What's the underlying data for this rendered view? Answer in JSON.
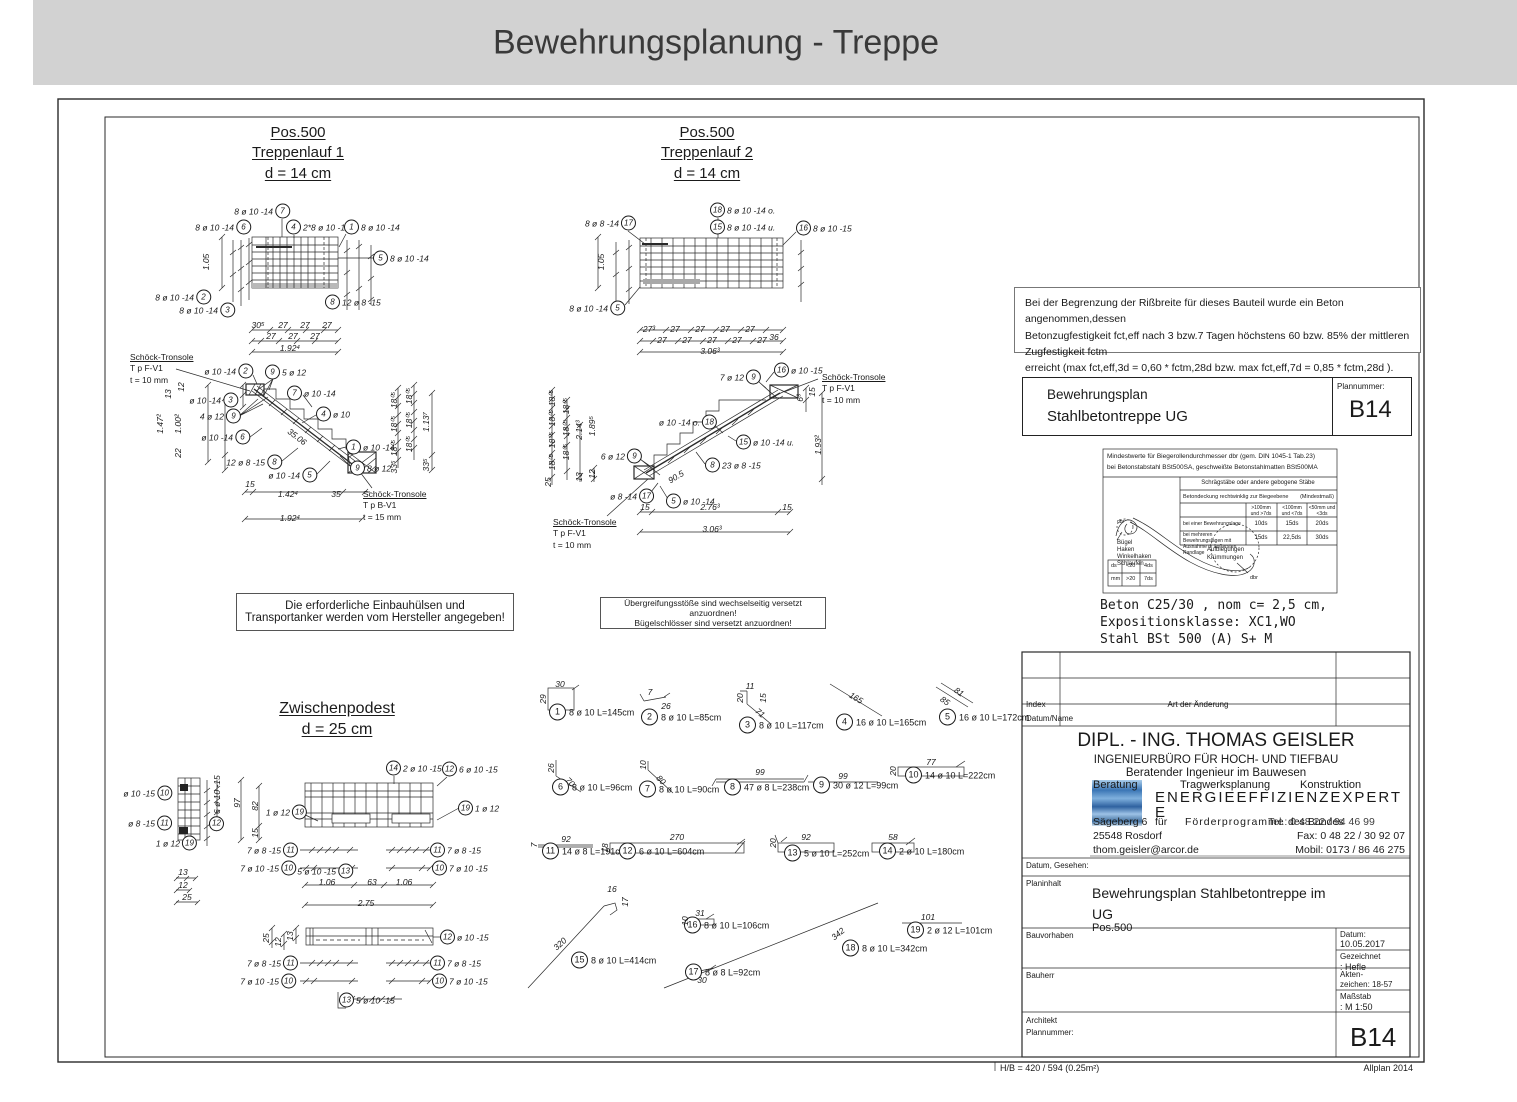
{
  "header": {
    "title": "Bewehrungsplanung - Treppe"
  },
  "lauf1": {
    "pos": "Pos.500",
    "name": "Treppenlauf 1",
    "thickness": "d = 14 cm"
  },
  "lauf2": {
    "pos": "Pos.500",
    "name": "Treppenlauf 2",
    "thickness": "d = 14 cm"
  },
  "podest": {
    "name": "Zwischenpodest",
    "thickness": "d = 25 cm"
  },
  "notes": {
    "n1a": "Die erforderliche Einbauhülsen und",
    "n1b": "Transportanker werden vom Hersteller angegeben!",
    "n2a": "Übergreifungsstöße sind wechselseitig versetzt anzuordnen!",
    "n2b": "Bügelschlösser sind versetzt anzuordnen!"
  },
  "risstext": {
    "l1": "Bei der Begrenzung der Rißbreite für dieses Bauteil wurde ein Beton angenommen,dessen",
    "l2": "Betonzugfestigkeit fct,eff nach 3 bzw.7 Tagen höchstens 60 bzw. 85% der mittleren Zugfestigkeit fctm",
    "l3": "erreicht (max  fct,eff,3d = 0,60 * fctm,28d bzw. max fct,eff,7d = 0,85 * fctm,28d ). Dies ist bei der Festlegung des",
    "l4": "Betons und der Bauausführung zu berücksichtigen."
  },
  "planbox": {
    "line1": "Bewehrungsplan",
    "line2": "Stahlbetontreppe UG",
    "plannummer_label": "Plannummer:",
    "plannummer": "B14"
  },
  "bend": {
    "h1": "Mindestwerte für Biegerollendurchmesser dbr (gem. DIN 1045-1 Tab.23)",
    "h2": "bei Betonstabstahl BSt500SA, geschweißte Betonstahlmatten BSt500MA",
    "sub1": "Schrägstäbe oder andere gebogene Stäbe",
    "sub2": "Betondeckung rechtwinklig zur Biegeebene",
    "sub2r": "(Mindestmaß)",
    "c1": ">100mm und >7ds",
    "c2": "<100mm und <7ds",
    "c3": "<50mm und <3ds",
    "r1": "bei einer Bewehrungslage",
    "r1v1": "10ds",
    "r1v2": "15ds",
    "r1v3": "20ds",
    "r2": "bei mehreren Bewehrungslagen mit Ausnahme d. äußersten Randlage",
    "r2v1": "15ds",
    "r2v2": "22,5ds",
    "r2v3": "30ds",
    "left1": "Bügel",
    "left2": "Haken",
    "left3": "Winkelhaken",
    "left4": "Schlaufen",
    "mini_ds": "ds",
    "mini_mm": "mm",
    "mini_lt": "<20",
    "mini_4": "4ds",
    "mini_gt": ">20",
    "mini_7": "7ds",
    "aufb": "Aufbiegungen",
    "krumm": "Krümmungen",
    "dbr": "dbr"
  },
  "beton": {
    "l1": "Beton C25/30 , nom c= 2,5 cm,",
    "l2": "Expositionsklasse:  XC1,WO",
    "l3": "Stahl BSt 500 (A) S+ M"
  },
  "titleblock": {
    "index": "Index",
    "art": "Art der Änderung",
    "datumname": "Datum/Name",
    "firm1": "DIPL. - ING.  THOMAS  GEISLER",
    "firm2": "INGENIEURBÜRO   FÜR   HOCH-   UND  TIEFBAU",
    "firm3": "Beratender    Ingenieur    im    Bauwesen",
    "beratung": "Beratung",
    "tragwerk": "Tragwerksplanung",
    "konstruktion": "Konstruktion",
    "energie1": "ENERGIEEFFIZIENZEXPERT",
    "energie2": "E",
    "addr1": "Sägeberg 6",
    "addr2": "25548 Rosdorf",
    "addr3": "thom.geisler@arcor.de",
    "fp1": "für",
    "fp2": "Förderprogramme",
    "bund": "des Bundes",
    "tel": "Tel.: 0 48 22 / 94 46 99",
    "fax": "Fax: 0 48 22 / 30 92 07",
    "mobil": "Mobil: 0173 / 86 46 275",
    "datumgesehen": "Datum, Gesehen:",
    "planinhalt_label": "Planinhalt",
    "planinhalt1": "Bewehrungsplan Stahlbetontreppe im",
    "planinhalt2": "UG",
    "planinhalt3": "Pos.500",
    "bauvorhaben": "Bauvorhaben",
    "datum_label": "Datum:",
    "datum": "10.05.2017",
    "gezeichnet_label": "Gezeichnet",
    "gezeichnet": ": Hefle",
    "bauherr": "Bauherr",
    "akten1": "Akten-",
    "akten2": "zeichen: 18-57",
    "massstab1": "Maßstab",
    "massstab2": ": M 1:50",
    "architekt": "Architekt",
    "plannummer_label": "Plannummer:",
    "plannummer": "B14"
  },
  "footer": {
    "format": "H/B = 420 / 594 (0.25m²)",
    "app": "Allplan 2014"
  },
  "schock": [
    {
      "l1": "Schöck-Tronsole",
      "l2": "T p F-V1",
      "l3": "t = 10 mm"
    },
    {
      "l1": "Schöck-Tronsole",
      "l2": "T p B-V1",
      "l3": "t = 15 mm"
    },
    {
      "l1": "Schöck-Tronsole",
      "l2": "T p F-V1",
      "l3": "t = 10 mm"
    },
    {
      "l1": "Schöck-Tronsole",
      "l2": "T p F-V1",
      "l3": "t = 10 mm"
    }
  ],
  "callouts": [
    {
      "n": "7",
      "t": "8 ø 10 -14"
    },
    {
      "n": "6",
      "t": "8 ø 10 -14"
    },
    {
      "n": "4",
      "t": "2*8 ø 10 -14"
    },
    {
      "n": "1",
      "t": "8 ø 10 -14"
    },
    {
      "n": "5",
      "t": "8 ø 10 -14"
    },
    {
      "n": "2",
      "t": "8 ø 10 -14"
    },
    {
      "n": "3",
      "t": "8 ø 10 -14"
    },
    {
      "n": "8",
      "t": "12 ø 8 -15"
    },
    {
      "n": "2",
      "t": "ø 10 -14"
    },
    {
      "n": "9",
      "t": "5 ø 12"
    },
    {
      "n": "3",
      "t": "ø 10 -14"
    },
    {
      "n": "9",
      "t": "4 ø 12"
    },
    {
      "n": "7",
      "t": "ø 10 -14"
    },
    {
      "n": "4",
      "t": "ø 10"
    },
    {
      "n": "6",
      "t": "ø 10 -14"
    },
    {
      "n": "8",
      "t": "12 ø 8 -15"
    },
    {
      "n": "5",
      "t": "ø 10 -14"
    },
    {
      "n": "1",
      "t": "ø 10 -14"
    },
    {
      "n": "9",
      "t": "8 ø 12"
    },
    {
      "n": "17",
      "t": "8 ø 8 -14"
    },
    {
      "n": "18",
      "t": "8 ø 10 -14 o."
    },
    {
      "n": "15",
      "t": "8 ø 10 -14 u."
    },
    {
      "n": "16",
      "t": "8 ø 10 -15"
    },
    {
      "n": "5",
      "t": "8 ø 10 -14"
    },
    {
      "n": "9",
      "t": "7 ø 12"
    },
    {
      "n": "16",
      "t": "ø 10 -15"
    },
    {
      "n": "18",
      "t": "ø 10 -14 o."
    },
    {
      "n": "15",
      "t": "ø 10 -14 u."
    },
    {
      "n": "8",
      "t": "23 ø 8 -15"
    },
    {
      "n": "9",
      "t": "6 ø 12"
    },
    {
      "n": "17",
      "t": "ø 8 -14"
    },
    {
      "n": "5",
      "t": "ø 10 -14"
    },
    {
      "n": "10",
      "t": "ø 10 -15"
    },
    {
      "n": "11",
      "t": "ø 8 -15"
    },
    {
      "n": "19",
      "t": "1 ø 12"
    },
    {
      "n": "12",
      "t": "6 ø 10 -15"
    },
    {
      "n": "19",
      "t": "1 ø 12"
    },
    {
      "n": "14",
      "t": "2 ø 10 -15"
    },
    {
      "n": "12",
      "t": "6 ø 10 -15"
    },
    {
      "n": "19",
      "t": "1 ø 12"
    },
    {
      "n": "11",
      "t": "7 ø 8 -15"
    },
    {
      "n": "11",
      "t": "7 ø 8 -15"
    },
    {
      "n": "10",
      "t": "7 ø 10 -15"
    },
    {
      "n": "10",
      "t": "7 ø 10 -15"
    },
    {
      "n": "13",
      "t": "5 ø 10 -15"
    },
    {
      "n": "12",
      "t": "ø 10 -15"
    },
    {
      "n": "11",
      "t": "7 ø 8 -15"
    },
    {
      "n": "11",
      "t": "7 ø 8 -15"
    },
    {
      "n": "10",
      "t": "7 ø 10 -15"
    },
    {
      "n": "10",
      "t": "7 ø 10 -15"
    },
    {
      "n": "13",
      "t": "5 ø 10 -15"
    }
  ],
  "schedule": [
    {
      "n": "1",
      "t": "8 ø 10 L=145cm"
    },
    {
      "n": "2",
      "t": "8 ø 10 L=85cm"
    },
    {
      "n": "3",
      "t": "8 ø 10 L=117cm"
    },
    {
      "n": "4",
      "t": "16 ø 10 L=165cm"
    },
    {
      "n": "5",
      "t": "16 ø 10 L=172cm"
    },
    {
      "n": "6",
      "t": "8 ø 10 L=96cm"
    },
    {
      "n": "7",
      "t": "8 ø 10 L=90cm"
    },
    {
      "n": "8",
      "t": "47 ø 8 L=238cm"
    },
    {
      "n": "9",
      "t": "30 ø 12 L=99cm"
    },
    {
      "n": "10",
      "t": "14 ø 10 L=222cm"
    },
    {
      "n": "11",
      "t": "14 ø 8 L=191cm"
    },
    {
      "n": "12",
      "t": "6 ø 10 L=604cm"
    },
    {
      "n": "13",
      "t": "5 ø 10 L=252cm"
    },
    {
      "n": "14",
      "t": "2 ø 10 L=180cm"
    },
    {
      "n": "15",
      "t": "8 ø 10 L=414cm"
    },
    {
      "n": "16",
      "t": "8 ø 10 L=106cm"
    },
    {
      "n": "17",
      "t": "8 ø 8 L=92cm"
    },
    {
      "n": "18",
      "t": "8 ø 10 L=342cm"
    },
    {
      "n": "19",
      "t": "2 ø 12 L=101cm"
    }
  ],
  "dims": [
    "1.05",
    "30⁵",
    "27",
    "27",
    "27",
    "27",
    "27",
    "27",
    "1.92⁴",
    "13",
    "12",
    "1.47²",
    "1.00²",
    "22",
    "18⁰⁵",
    "18⁰⁵",
    "18⁰⁵",
    "18⁰⁵",
    "18⁰⁵",
    "18⁰⁵",
    "33⁵",
    "1.13⁷",
    "33⁵",
    "15",
    "1.42⁴",
    "35",
    "1.92⁴",
    "1.05",
    "27³",
    "27",
    "27",
    "27",
    "27",
    "36",
    "27",
    "27",
    "27",
    "27",
    "27",
    "3.06³",
    "25",
    "18⁰⁵",
    "18⁰⁵",
    "18⁰⁵",
    "18⁰⁵",
    "18⁰⁵",
    "18⁰⁵",
    "18⁰⁵",
    "2.14³",
    "1.89⁵",
    "13",
    "12",
    "6³",
    "15",
    "1.93²",
    "15",
    "2.76³",
    "15",
    "3.06³",
    "97",
    "82",
    "15",
    "13",
    "12",
    "25",
    "1.06",
    "63",
    "1.06",
    "2.75",
    "25",
    "12",
    "13",
    "30",
    "29",
    "26",
    "7",
    "11",
    "15",
    "20",
    "71",
    "165",
    "81",
    "85",
    "26",
    "70",
    "10",
    "80",
    "99",
    "99",
    "77",
    "20",
    "92",
    "7",
    "270",
    "18",
    "92",
    "20",
    "58",
    "320",
    "16",
    "17",
    "31",
    "10",
    "30",
    "342",
    "101",
    "35.06",
    "90.5"
  ]
}
